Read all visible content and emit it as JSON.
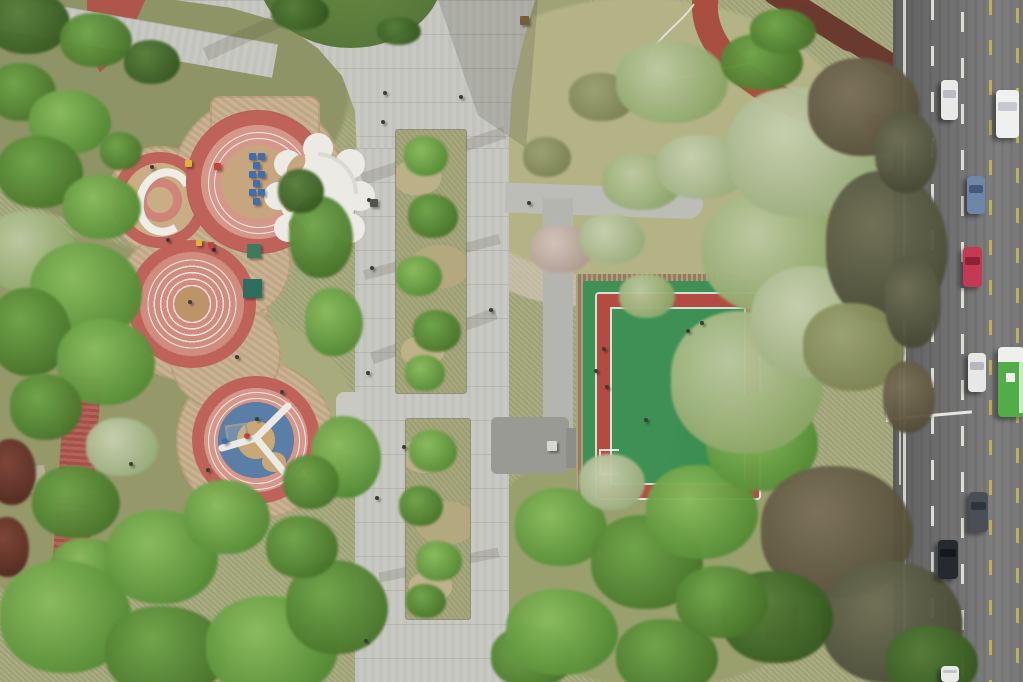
{
  "meta": {
    "description": "Aerial drone photograph of an urban park in spring: circular children playground with white canopy, paved central plaza with two tree planting beds, green multi-sport court with red border band, red jogging paths, dense spring trees, and a multi-lane road with traffic on the right edge",
    "season_hint": "spring",
    "view": "top-down aerial"
  },
  "palette": {
    "grass": "#a6a97b",
    "plaza": "#c9c9c3",
    "tan": "#c6ae8b",
    "tanc": "#c9a876",
    "redring": "#bf625a",
    "pink": "#d6978b",
    "redpath": "#ae564c",
    "track": "#a84f3f",
    "maroon": "#6e3a2e",
    "bed": "#a3a478",
    "cgreen": "#3e9055",
    "cred": "#b44b43",
    "curb": "#a08565",
    "blue": "#5a7ea5",
    "white": "#efede7",
    "yellow": "#bfae56"
  },
  "tree_kinds": {
    "g1": [
      "#8abc5e",
      "#538a33"
    ],
    "g2": [
      "#6fa549",
      "#477329"
    ],
    "g3": [
      "#567f3a",
      "#365820"
    ],
    "pl": [
      "#bec9a2",
      "#8ba565"
    ],
    "p2": [
      "#c8d0b0",
      "#9aac7c"
    ],
    "db": [
      "#6e6f55",
      "#4a4b37"
    ],
    "b2": [
      "#7b7158",
      "#554e39"
    ],
    "mr": [
      "#7c4336",
      "#552a20"
    ],
    "ol": [
      "#9ba171",
      "#7a8150"
    ],
    "bl": [
      "#d2c4ba",
      "#b09a90"
    ]
  },
  "vegetation": [
    [
      28,
      22,
      84,
      64,
      "g3"
    ],
    [
      96,
      40,
      72,
      54,
      "g2"
    ],
    [
      22,
      92,
      68,
      58,
      "g2"
    ],
    [
      70,
      122,
      82,
      64,
      "g1"
    ],
    [
      152,
      62,
      56,
      44,
      "g3"
    ],
    [
      40,
      172,
      86,
      72,
      "g2"
    ],
    [
      102,
      207,
      78,
      64,
      "g1"
    ],
    [
      30,
      252,
      92,
      82,
      "pl"
    ],
    [
      86,
      292,
      112,
      98,
      "g1"
    ],
    [
      30,
      332,
      82,
      88,
      "g2"
    ],
    [
      106,
      362,
      98,
      86,
      "g1"
    ],
    [
      46,
      407,
      72,
      66,
      "g2"
    ],
    [
      12,
      472,
      48,
      66,
      "mr"
    ],
    [
      8,
      547,
      42,
      60,
      "mr"
    ],
    [
      122,
      447,
      72,
      58,
      "p2"
    ],
    [
      76,
      502,
      88,
      72,
      "g2"
    ],
    [
      88,
      565,
      74,
      54,
      "g1"
    ],
    [
      162,
      557,
      112,
      94,
      "g1"
    ],
    [
      66,
      617,
      132,
      112,
      "g1"
    ],
    [
      166,
      652,
      122,
      92,
      "g2"
    ],
    [
      272,
      647,
      132,
      102,
      "g1"
    ],
    [
      337,
      607,
      102,
      94,
      "g2"
    ],
    [
      227,
      517,
      86,
      74,
      "g1"
    ],
    [
      302,
      547,
      72,
      62,
      "g2"
    ],
    [
      321,
      237,
      64,
      82,
      "g2"
    ],
    [
      334,
      322,
      58,
      68,
      "g1"
    ],
    [
      301,
      191,
      46,
      44,
      "g3"
    ],
    [
      346,
      457,
      70,
      82,
      "g1"
    ],
    [
      311,
      482,
      56,
      54,
      "g2"
    ],
    [
      121,
      151,
      42,
      38,
      "g2"
    ],
    [
      426,
      156,
      44,
      40,
      "g1"
    ],
    [
      433,
      216,
      50,
      44,
      "g2"
    ],
    [
      419,
      276,
      46,
      40,
      "g1"
    ],
    [
      437,
      331,
      48,
      42,
      "g2"
    ],
    [
      425,
      373,
      40,
      36,
      "g1"
    ],
    [
      433,
      451,
      48,
      42,
      "g1"
    ],
    [
      421,
      506,
      44,
      40,
      "g2"
    ],
    [
      439,
      561,
      46,
      40,
      "g1"
    ],
    [
      426,
      601,
      40,
      34,
      "g2"
    ],
    [
      532,
      657,
      82,
      62,
      "g2"
    ],
    [
      561,
      527,
      92,
      78,
      "g1"
    ],
    [
      647,
      562,
      112,
      94,
      "g2"
    ],
    [
      562,
      632,
      112,
      86,
      "g1"
    ],
    [
      667,
      657,
      102,
      76,
      "g2"
    ],
    [
      612,
      482,
      66,
      56,
      "p2"
    ],
    [
      702,
      512,
      112,
      94,
      "g1"
    ],
    [
      762,
      442,
      112,
      98,
      "g1"
    ],
    [
      561,
      249,
      62,
      48,
      "bl"
    ],
    [
      612,
      239,
      66,
      50,
      "p2"
    ],
    [
      647,
      296,
      56,
      44,
      "pl"
    ],
    [
      547,
      157,
      48,
      40,
      "ol"
    ],
    [
      642,
      182,
      80,
      56,
      "pl"
    ],
    [
      702,
      167,
      92,
      64,
      "p2"
    ],
    [
      602,
      97,
      66,
      48,
      "ol"
    ],
    [
      772,
      252,
      140,
      122,
      "pl"
    ],
    [
      747,
      382,
      152,
      142,
      "pl"
    ],
    [
      812,
      322,
      122,
      112,
      "p2"
    ],
    [
      802,
      152,
      150,
      130,
      "p2"
    ],
    [
      672,
      82,
      112,
      82,
      "pl"
    ],
    [
      762,
      62,
      82,
      56,
      "g2"
    ],
    [
      864,
      107,
      112,
      98,
      "b2"
    ],
    [
      887,
      247,
      122,
      152,
      "db"
    ],
    [
      854,
      347,
      102,
      88,
      "ol"
    ],
    [
      906,
      152,
      62,
      82,
      "db"
    ],
    [
      913,
      302,
      56,
      92,
      "db"
    ],
    [
      909,
      397,
      52,
      72,
      "b2"
    ],
    [
      837,
      532,
      152,
      132,
      "b2"
    ],
    [
      892,
      622,
      142,
      122,
      "db"
    ],
    [
      777,
      617,
      112,
      92,
      "g3"
    ],
    [
      722,
      602,
      92,
      72,
      "g2"
    ],
    [
      932,
      662,
      92,
      72,
      "g3"
    ],
    [
      300,
      12,
      58,
      36,
      "g3"
    ],
    [
      399,
      31,
      44,
      28,
      "g3"
    ],
    [
      783,
      31,
      66,
      44,
      "g2"
    ]
  ],
  "people_and_items": [
    {
      "x": 383,
      "y": 122
    },
    {
      "x": 369,
      "y": 200
    },
    {
      "x": 372,
      "y": 268
    },
    {
      "x": 491,
      "y": 310
    },
    {
      "x": 404,
      "y": 447
    },
    {
      "x": 377,
      "y": 498
    },
    {
      "x": 368,
      "y": 373
    },
    {
      "x": 366,
      "y": 641
    },
    {
      "x": 529,
      "y": 203
    },
    {
      "x": 461,
      "y": 97
    },
    {
      "x": 385,
      "y": 93
    },
    {
      "x": 688,
      "y": 331
    },
    {
      "x": 702,
      "y": 323
    },
    {
      "x": 604,
      "y": 349
    },
    {
      "x": 596,
      "y": 371
    },
    {
      "x": 607,
      "y": 387
    },
    {
      "x": 646,
      "y": 420
    },
    {
      "x": 152,
      "y": 167
    },
    {
      "x": 214,
      "y": 250
    },
    {
      "x": 190,
      "y": 302
    },
    {
      "x": 131,
      "y": 464
    },
    {
      "x": 208,
      "y": 470
    },
    {
      "x": 257,
      "y": 419
    },
    {
      "x": 237,
      "y": 357
    },
    {
      "x": 168,
      "y": 240
    },
    {
      "x": 282,
      "y": 392
    },
    {
      "x": 188,
      "y": 163,
      "c": "#dfb33a",
      "s": 7,
      "q": "s"
    },
    {
      "x": 217,
      "y": 166,
      "c": "#c24438",
      "s": 7,
      "q": "s"
    },
    {
      "x": 199,
      "y": 243,
      "c": "#dfb33a",
      "s": 6,
      "q": "s"
    },
    {
      "x": 211,
      "y": 245,
      "c": "#c24438",
      "s": 6,
      "q": "s"
    },
    {
      "x": 247,
      "y": 436,
      "c": "#c24438",
      "s": 6
    },
    {
      "x": 225,
      "y": 441,
      "c": "#3f6db0",
      "s": 6
    },
    {
      "x": 252,
      "y": 156,
      "c": "#3f6db0",
      "s": 7,
      "q": "s"
    },
    {
      "x": 261,
      "y": 156,
      "c": "#3f6db0",
      "s": 7,
      "q": "s"
    },
    {
      "x": 256,
      "y": 165,
      "c": "#3f6db0",
      "s": 7,
      "q": "s"
    },
    {
      "x": 252,
      "y": 174,
      "c": "#3f6db0",
      "s": 7,
      "q": "s"
    },
    {
      "x": 261,
      "y": 174,
      "c": "#3f6db0",
      "s": 7,
      "q": "s"
    },
    {
      "x": 256,
      "y": 183,
      "c": "#3f6db0",
      "s": 7,
      "q": "s"
    },
    {
      "x": 252,
      "y": 192,
      "c": "#3f6db0",
      "s": 7,
      "q": "s"
    },
    {
      "x": 261,
      "y": 192,
      "c": "#3f6db0",
      "s": 7,
      "q": "s"
    },
    {
      "x": 256,
      "y": 201,
      "c": "#3f6db0",
      "s": 7,
      "q": "s"
    },
    {
      "x": 254,
      "y": 251,
      "c": "#3f7a5a",
      "s": 14,
      "q": "s"
    },
    {
      "x": 252,
      "y": 288,
      "c": "#2e6e5e",
      "s": 19,
      "q": "s"
    },
    {
      "x": 524,
      "y": 20,
      "c": "#7a5b3a",
      "s": 9,
      "q": "s"
    },
    {
      "x": 552,
      "y": 446,
      "c": "#d8d8d2",
      "s": 10,
      "q": "s"
    },
    {
      "x": 374,
      "y": 203,
      "c": "#55544c",
      "s": 8,
      "q": "s"
    }
  ],
  "vehicles": [
    {
      "x": 941,
      "y": 80,
      "w": 17,
      "h": 40,
      "c": "#e9e9e7",
      "ws": "#b7bcc2",
      "t": "white-sedan"
    },
    {
      "x": 996,
      "y": 90,
      "w": 23,
      "h": 48,
      "c": "#f0f0ee",
      "ws": "#c6cacf",
      "t": "white-van"
    },
    {
      "x": 967,
      "y": 176,
      "w": 18,
      "h": 38,
      "c": "#6e86a8",
      "ws": "#45597a",
      "t": "blue-sedan"
    },
    {
      "x": 963,
      "y": 247,
      "w": 19,
      "h": 40,
      "c": "#c43a52",
      "ws": "#8c2138",
      "t": "red-sedan"
    },
    {
      "x": 968,
      "y": 353,
      "w": 18,
      "h": 39,
      "c": "#e7e7e5",
      "ws": "#b4b9bf",
      "t": "white-sedan"
    },
    {
      "x": 998,
      "y": 347,
      "w": 26,
      "h": 70,
      "c": "#52ac47",
      "ws": "#eef0ee",
      "t": "green-bus"
    },
    {
      "x": 969,
      "y": 492,
      "w": 19,
      "h": 40,
      "c": "#4a4f55",
      "ws": "#2f343a",
      "t": "gray-sedan"
    },
    {
      "x": 938,
      "y": 540,
      "w": 20,
      "h": 39,
      "c": "#26292e",
      "ws": "#14171b",
      "t": "black-sedan"
    },
    {
      "x": 941,
      "y": 666,
      "w": 18,
      "h": 16,
      "c": "#e9e9e7",
      "ws": "#c0c4c8",
      "t": "white-sedan-partial"
    }
  ]
}
